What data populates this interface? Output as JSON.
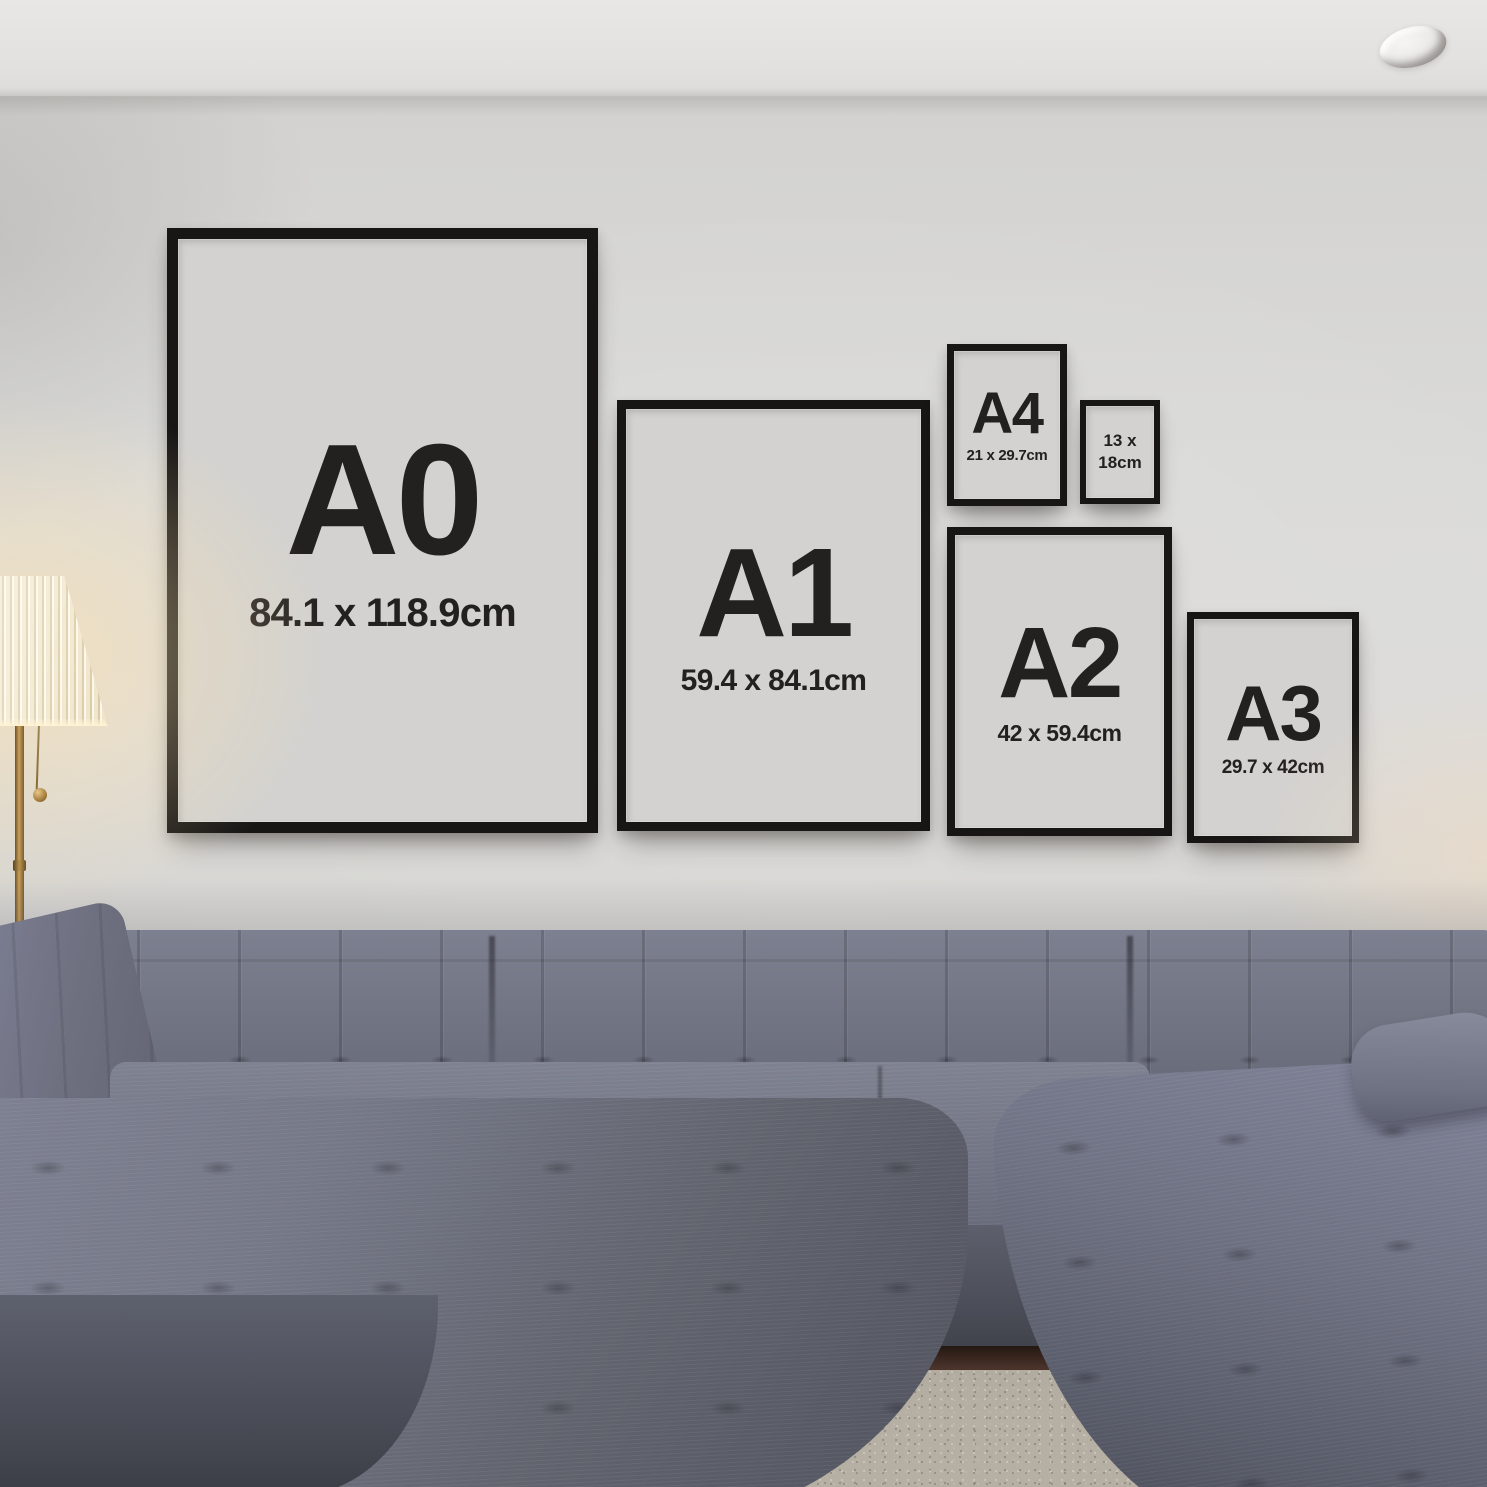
{
  "frames": [
    {
      "id": "A0",
      "label": "A0",
      "dimensions": "84.1 x 118.9cm"
    },
    {
      "id": "A1",
      "label": "A1",
      "dimensions": "59.4 x 84.1cm"
    },
    {
      "id": "A4",
      "label": "A4",
      "dimensions": "21 x 29.7cm"
    },
    {
      "id": "13x18",
      "label": "13 x",
      "dimensions": "18cm"
    },
    {
      "id": "A2",
      "label": "A2",
      "dimensions": "42 x 59.4cm"
    },
    {
      "id": "A3",
      "label": "A3",
      "dimensions": "29.7 x 42cm"
    }
  ],
  "colors": {
    "wall": "#d7d6d4",
    "ceiling": "#e6e5e3",
    "frame-black": "#171615",
    "mat": "#d3d2d0",
    "ink": "#232020",
    "sofa-light": "#7d8090",
    "sofa-mid": "#6b6e7c",
    "sofa-dark": "#4b4e59",
    "rug": "#b5afa4",
    "floor": "#4c342b",
    "brass": "#c09a58",
    "glow": "#ffe2ae",
    "shade": "#f9f2de"
  }
}
